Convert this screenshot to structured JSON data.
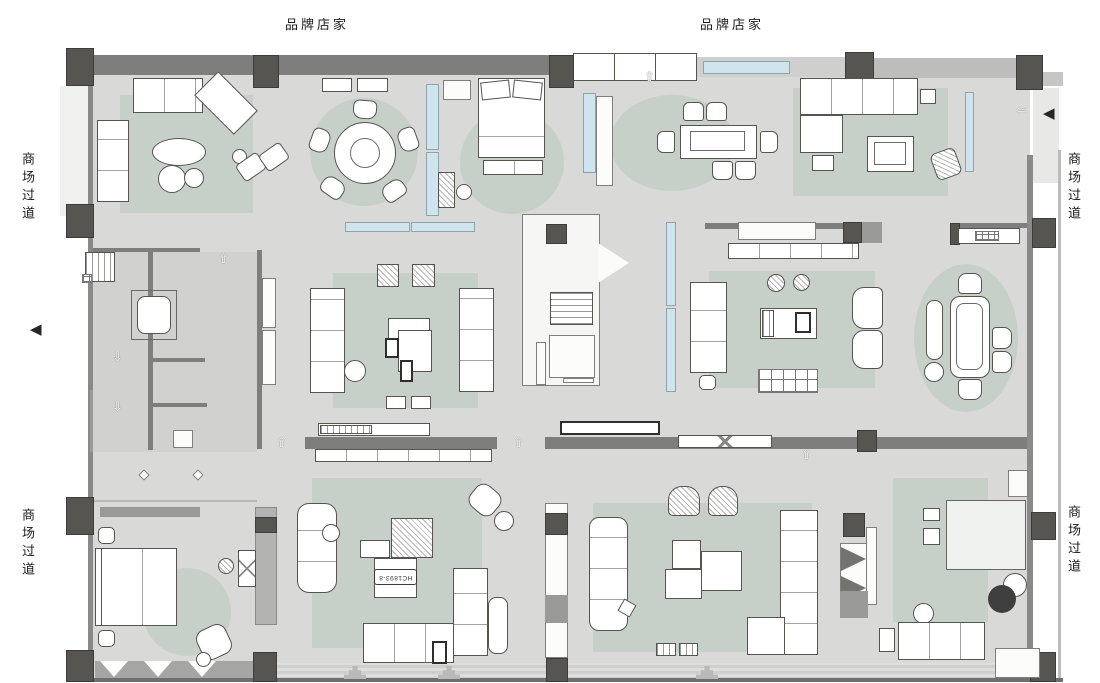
{
  "labels": {
    "brand_store": "品牌店家",
    "mall_corridor": "商场过道",
    "product_code": "HC1893-8"
  },
  "colors": {
    "floor": "#d9d9d7",
    "service_floor": "#d1d1cf",
    "wall": "#7e7e7c",
    "column": "#565551",
    "rug_sage": "#c7d0c8",
    "display_blue": "#cfe4ec",
    "furniture_outline": "#55544f",
    "dark_accent_circle": "#3f3f3f"
  },
  "icons": {
    "up_arrow": "⇧",
    "down_arrow": "⇩",
    "left_arrow_small": "⇦",
    "entrance_arrow": "◀"
  }
}
